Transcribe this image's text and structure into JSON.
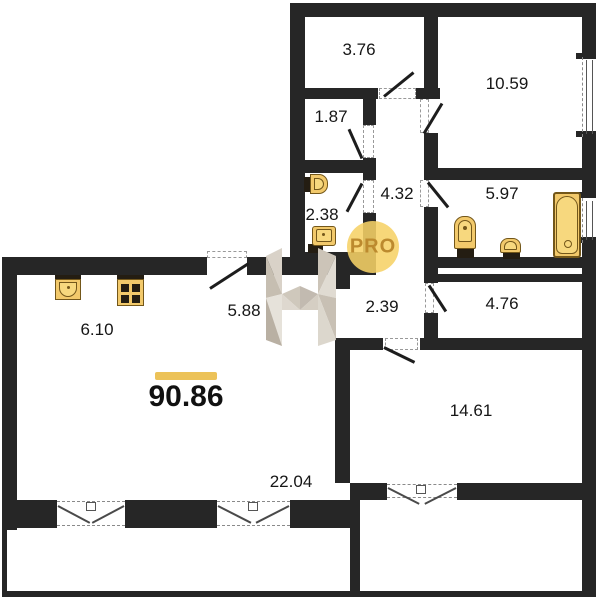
{
  "watermark": {
    "brand_label": "PRO"
  },
  "summary": {
    "total_area": "90.86"
  },
  "rooms": [
    {
      "id": "room-3-76",
      "area": "3.76"
    },
    {
      "id": "room-10-59",
      "area": "10.59"
    },
    {
      "id": "room-1-87",
      "area": "1.87"
    },
    {
      "id": "corridor-4-32",
      "area": "4.32"
    },
    {
      "id": "bathroom-5-97",
      "area": "5.97"
    },
    {
      "id": "wc-2-38",
      "area": "2.38"
    },
    {
      "id": "hall-2-39",
      "area": "2.39"
    },
    {
      "id": "room-4-76",
      "area": "4.76"
    },
    {
      "id": "entry-5-88",
      "area": "5.88"
    },
    {
      "id": "kitchen-6-10",
      "area": "6.10"
    },
    {
      "id": "living-22-04",
      "area": "22.04"
    },
    {
      "id": "room-14-61",
      "area": "14.61"
    }
  ],
  "fixtures": [
    "kitchen-sink",
    "stove",
    "toilet",
    "wash-basin",
    "bathtub"
  ],
  "colors": {
    "wall": "#262626",
    "gold": "#f2c96b",
    "gold_border": "#73571a",
    "gold_light": "#f7d87e",
    "accent": "#ecc258",
    "circle": "#f6d267",
    "brand_text": "#bc8a2e"
  }
}
